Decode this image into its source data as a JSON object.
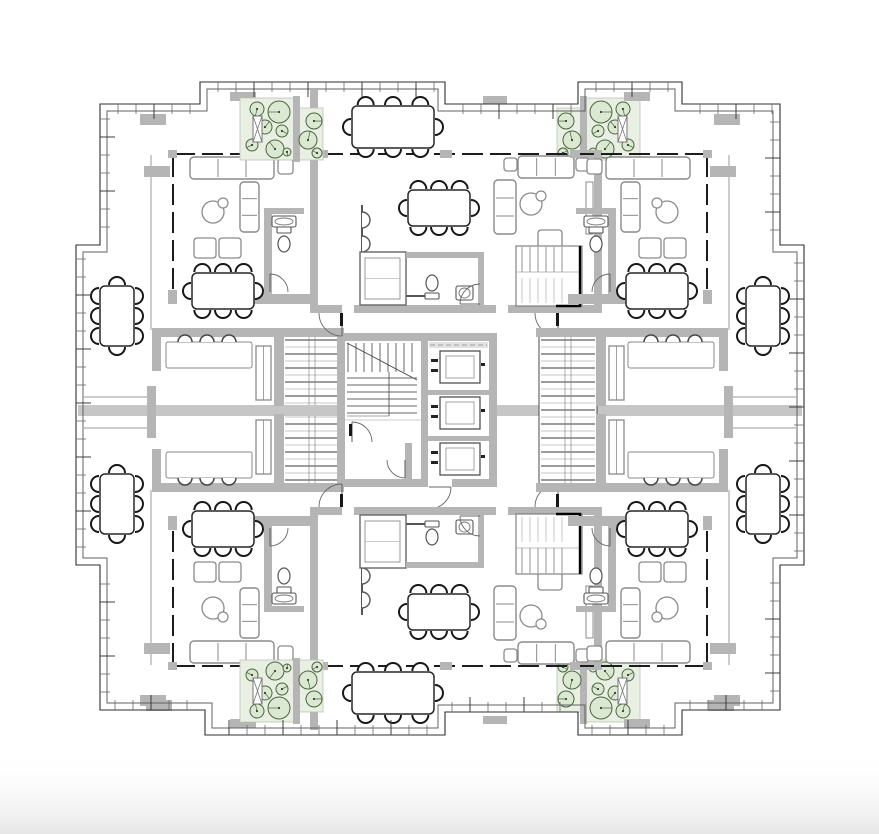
{
  "meta": {
    "title": "Residential tower typical floor plan",
    "type": "architectural-plan"
  },
  "canvas": {
    "w": 879,
    "h": 834,
    "bg": "#ffffff",
    "fade": {
      "y": 752,
      "h": 82,
      "from": "#ffffff",
      "to": "#e7e7e7"
    }
  },
  "mirror": {
    "cx": 440,
    "cy": 410
  },
  "palette": {
    "wall": "#b5b5b5",
    "band": "#c6c6c6",
    "pl": "#e9f0e3",
    "plb": "#b9c6b1",
    "treeFill": "#dce9d2",
    "treeLine": "#4a653e",
    "line": "#2f2f2f",
    "inner": "#606060",
    "furn": "#8a8a8a",
    "dark": "#171717",
    "win": "#1c1c1c"
  },
  "facade": {
    "outer": [
      [
        100,
        104
      ],
      [
        200,
        104
      ],
      [
        200,
        82
      ],
      [
        445,
        82
      ],
      [
        445,
        104
      ],
      [
        578,
        104
      ],
      [
        578,
        82
      ],
      [
        682,
        82
      ],
      [
        682,
        104
      ],
      [
        780,
        104
      ],
      [
        780,
        245
      ],
      [
        804,
        245
      ],
      [
        804,
        565
      ],
      [
        780,
        565
      ],
      [
        780,
        710
      ],
      [
        682,
        710
      ],
      [
        682,
        735
      ],
      [
        578,
        735
      ],
      [
        578,
        712
      ],
      [
        445,
        712
      ],
      [
        445,
        735
      ],
      [
        205,
        735
      ],
      [
        205,
        710
      ],
      [
        100,
        710
      ],
      [
        100,
        565
      ],
      [
        76,
        565
      ],
      [
        76,
        245
      ],
      [
        100,
        245
      ]
    ],
    "inner": [
      [
        107,
        111
      ],
      [
        207,
        111
      ],
      [
        207,
        89
      ],
      [
        438,
        89
      ],
      [
        438,
        111
      ],
      [
        585,
        111
      ],
      [
        585,
        89
      ],
      [
        675,
        89
      ],
      [
        675,
        111
      ],
      [
        773,
        111
      ],
      [
        773,
        252
      ],
      [
        797,
        252
      ],
      [
        797,
        558
      ],
      [
        773,
        558
      ],
      [
        773,
        703
      ],
      [
        675,
        703
      ],
      [
        675,
        728
      ],
      [
        585,
        728
      ],
      [
        585,
        705
      ],
      [
        438,
        705
      ],
      [
        438,
        728
      ],
      [
        212,
        728
      ],
      [
        212,
        703
      ],
      [
        107,
        703
      ],
      [
        107,
        558
      ],
      [
        83,
        558
      ],
      [
        83,
        252
      ],
      [
        107,
        252
      ]
    ],
    "tickStep": 18,
    "tickMajorEvery": 3
  },
  "items": [
    {
      "t": "rect",
      "r": [
        557,
        108,
        26,
        52
      ],
      "f": "pl",
      "s": "plb",
      "w": 0.8,
      "m": "x y xy",
      "name": "planter-small"
    },
    {
      "t": "rect",
      "r": [
        586,
        98,
        54,
        62
      ],
      "f": "pl",
      "s": "plb",
      "w": 0.8,
      "m": "x y xy",
      "name": "planter-large"
    },
    {
      "t": "rect",
      "r": [
        580,
        96,
        7,
        66
      ],
      "f": "wall",
      "m": "x y xy",
      "name": "planter-divider-wall"
    },
    {
      "t": "trees",
      "c": [
        [
          601,
          112,
          11
        ],
        [
          623,
          109,
          7
        ],
        [
          598,
          131,
          6
        ],
        [
          615,
          127,
          7
        ],
        [
          605,
          149,
          9
        ],
        [
          628,
          145,
          6
        ],
        [
          593,
          152,
          4
        ],
        [
          566,
          121,
          8
        ],
        [
          572,
          140,
          9
        ],
        [
          563,
          153,
          5
        ]
      ],
      "m": "x y xy",
      "name": "terrace-trees"
    },
    {
      "t": "bench",
      "r": [
        618,
        116,
        9,
        26
      ],
      "m": "x y xy",
      "name": "terrace-bench"
    },
    {
      "t": "shaft",
      "r": [
        283,
        333,
        58,
        154
      ],
      "m": "x",
      "name": "scissor-stair-shaft"
    },
    {
      "t": "rect",
      "r": [
        78,
        405,
        263,
        11
      ],
      "f": "band",
      "name": "expansion-band"
    },
    {
      "t": "rect",
      "r": [
        497,
        405,
        305,
        11
      ],
      "f": "band",
      "name": "expansion-band"
    },
    {
      "t": "line",
      "p": [
        84,
        397,
        151,
        397
      ],
      "s": "#9a9a9a",
      "w": 1,
      "m": "x",
      "name": "terrace-edge-line"
    },
    {
      "t": "line",
      "p": [
        84,
        428,
        151,
        428
      ],
      "s": "#9a9a9a",
      "w": 1,
      "m": "x",
      "name": "terrace-edge-line"
    },
    {
      "t": "rect",
      "r": [
        147,
        386,
        9,
        52
      ],
      "f": "wall",
      "m": "x",
      "name": "terrace-pier"
    },
    {
      "t": "rect",
      "r": [
        152,
        328,
        192,
        9
      ],
      "f": "wall",
      "m": "x y xy",
      "name": "midroom-wall"
    },
    {
      "t": "rect",
      "r": [
        152,
        337,
        9,
        34
      ],
      "f": "wall",
      "m": "x y xy",
      "name": "midroom-wall"
    },
    {
      "t": "rect",
      "r": [
        274,
        330,
        10,
        76
      ],
      "f": "wall",
      "m": "x y xy",
      "name": "midroom-wall"
    },
    {
      "t": "rect",
      "r": [
        166,
        342,
        86,
        26
      ],
      "s": "furn",
      "f": "#fff",
      "rx": 2,
      "m": "x y xy",
      "name": "daybed"
    },
    {
      "t": "chairs",
      "c": [
        [
          185,
          342
        ],
        [
          207,
          342
        ],
        [
          229,
          342
        ]
      ],
      "d": "up",
      "cr": 7,
      "m": "x y xy",
      "name": "seat-scallops"
    },
    {
      "t": "cab",
      "r": [
        256,
        346,
        15,
        54
      ],
      "m": "x y xy",
      "name": "cabinet"
    },
    {
      "t": "rect",
      "r": [
        337,
        333,
        8,
        154
      ],
      "f": "wall",
      "name": "core-wall"
    },
    {
      "t": "rect",
      "r": [
        337,
        333,
        160,
        8
      ],
      "f": "wall",
      "name": "core-wall"
    },
    {
      "t": "rect",
      "r": [
        489,
        333,
        8,
        154
      ],
      "f": "wall",
      "name": "core-wall"
    },
    {
      "t": "rect",
      "r": [
        337,
        479,
        90,
        8
      ],
      "f": "wall",
      "name": "core-wall"
    },
    {
      "t": "rect",
      "r": [
        452,
        479,
        45,
        8
      ],
      "f": "wall",
      "name": "core-wall"
    },
    {
      "t": "rect",
      "r": [
        421,
        341,
        7,
        146
      ],
      "f": "wall",
      "name": "core-wall"
    },
    {
      "t": "corestair",
      "r": [
        345,
        341,
        76,
        146
      ],
      "name": "core-stairs"
    },
    {
      "t": "elev",
      "r": [
        428,
        341,
        61,
        146
      ],
      "name": "elevator-bank"
    },
    {
      "t": "arc",
      "a": [
        352,
        442,
        20,
        270,
        360
      ],
      "name": "door-swing"
    },
    {
      "t": "arc",
      "a": [
        429,
        487,
        22,
        0,
        90
      ],
      "name": "door-swing"
    },
    {
      "t": "rect",
      "r": [
        349,
        424,
        3,
        12
      ],
      "f": "dark",
      "name": "door-leaf"
    },
    {
      "t": "rect",
      "r": [
        405,
        443,
        7,
        44
      ],
      "f": "wall",
      "name": "core-wall"
    },
    {
      "t": "arc",
      "a": [
        405,
        460,
        18,
        90,
        180
      ],
      "name": "door-swing"
    },
    {
      "t": "rect",
      "r": [
        310,
        90,
        8,
        223
      ],
      "f": "wall",
      "m": "y",
      "name": "unit-wall"
    },
    {
      "t": "rect",
      "r": [
        594,
        150,
        8,
        163
      ],
      "f": "wall",
      "m": "y",
      "name": "unit-wall"
    },
    {
      "t": "rect",
      "r": [
        310,
        305,
        32,
        8
      ],
      "f": "wall",
      "m": "y",
      "name": "unit-wall"
    },
    {
      "t": "rect",
      "r": [
        354,
        305,
        142,
        8
      ],
      "f": "wall",
      "m": "y",
      "name": "unit-wall"
    },
    {
      "t": "rect",
      "r": [
        508,
        305,
        94,
        8
      ],
      "f": "wall",
      "m": "y",
      "name": "unit-wall"
    },
    {
      "t": "dash",
      "p": [
        322,
        154,
        592,
        154
      ],
      "m": "y",
      "name": "window-wall"
    },
    {
      "t": "rect",
      "r": [
        318,
        150,
        10,
        8
      ],
      "f": "wall",
      "m": "y",
      "name": "mullion-pier"
    },
    {
      "t": "rect",
      "r": [
        440,
        150,
        12,
        8
      ],
      "f": "wall",
      "m": "y",
      "name": "mullion-pier"
    },
    {
      "t": "rect",
      "r": [
        584,
        150,
        10,
        8
      ],
      "f": "wall",
      "m": "y",
      "name": "mullion-pier"
    },
    {
      "t": "kitchen",
      "p": [
        362,
        205,
        362,
        296,
        432,
        296
      ],
      "ar": [
        [
          362,
          220
        ],
        [
          362,
          244
        ],
        [
          362,
          268
        ]
      ],
      "m": "y",
      "name": "kitchen-counter"
    },
    {
      "t": "tableH",
      "r": [
        408,
        190,
        62,
        36
      ],
      "m": "y",
      "name": "dining-table"
    },
    {
      "t": "sofa",
      "r": [
        518,
        156,
        56,
        22
      ],
      "m": "y",
      "name": "sofa"
    },
    {
      "t": "sq",
      "r": [
        504,
        158,
        13,
        13
      ],
      "m": "y",
      "name": "side-table"
    },
    {
      "t": "sq",
      "r": [
        576,
        158,
        13,
        13
      ],
      "m": "y",
      "name": "side-table"
    },
    {
      "t": "chaise",
      "r": [
        494,
        180,
        22,
        54
      ],
      "m": "y",
      "name": "chaise"
    },
    {
      "t": "rtable",
      "c": [
        531,
        204,
        11,
        541,
        196,
        5
      ],
      "m": "y",
      "name": "coffee-table"
    },
    {
      "t": "sq",
      "r": [
        538,
        230,
        24,
        22
      ],
      "m": "y",
      "name": "armchair"
    },
    {
      "t": "rect",
      "r": [
        586,
        182,
        7,
        52
      ],
      "s": "furn",
      "f": "#fff",
      "m": "y",
      "name": "console"
    },
    {
      "t": "closet",
      "r": [
        360,
        252,
        46,
        53
      ],
      "m": "y",
      "name": "wardrobe"
    },
    {
      "t": "rect",
      "r": [
        406,
        252,
        78,
        6
      ],
      "f": "wall",
      "m": "y",
      "name": "bath-wall"
    },
    {
      "t": "rect",
      "r": [
        478,
        252,
        6,
        56
      ],
      "f": "wall",
      "m": "y",
      "name": "bath-wall"
    },
    {
      "t": "toilet",
      "c": [
        432,
        283
      ],
      "tk": "s",
      "m": "y",
      "name": "toilet"
    },
    {
      "t": "sink",
      "r": [
        456,
        286,
        17,
        14
      ],
      "m": "y",
      "name": "sink"
    },
    {
      "t": "arc",
      "a": [
        480,
        304,
        20,
        180,
        270
      ],
      "m": "y",
      "name": "door-swing"
    },
    {
      "t": "stairs",
      "r": [
        516,
        246,
        66,
        60
      ],
      "m": "y",
      "name": "duplex-stair"
    },
    {
      "t": "arc",
      "a": [
        342,
        313,
        23,
        90,
        180
      ],
      "m": "y",
      "name": "door-swing"
    },
    {
      "t": "rect",
      "r": [
        340,
        313,
        3,
        13
      ],
      "f": "dark",
      "m": "y",
      "name": "door-leaf"
    },
    {
      "t": "arc",
      "a": [
        558,
        313,
        23,
        90,
        180
      ],
      "m": "y",
      "name": "door-swing"
    },
    {
      "t": "rect",
      "r": [
        556,
        313,
        3,
        13
      ],
      "f": "dark",
      "m": "y",
      "name": "door-leaf"
    },
    {
      "t": "dash",
      "p": [
        174,
        154,
        306,
        154
      ],
      "m": "x y xy",
      "name": "window-wall"
    },
    {
      "t": "dashv",
      "p": [
        173,
        156,
        173,
        298
      ],
      "m": "x y xy",
      "name": "window-wall"
    },
    {
      "t": "rect",
      "r": [
        168,
        150,
        9,
        8
      ],
      "f": "wall",
      "m": "x y xy",
      "name": "mullion-pier"
    },
    {
      "t": "rect",
      "r": [
        300,
        150,
        10,
        8
      ],
      "f": "wall",
      "m": "x y xy",
      "name": "mullion-pier"
    },
    {
      "t": "rect",
      "r": [
        230,
        294,
        82,
        10
      ],
      "f": "wall",
      "m": "x y xy",
      "name": "unit-wall"
    },
    {
      "t": "rect",
      "r": [
        168,
        290,
        9,
        14
      ],
      "f": "wall",
      "m": "x y xy",
      "name": "unit-wall"
    },
    {
      "t": "sofa",
      "r": [
        190,
        157,
        84,
        22
      ],
      "m": "x y xy",
      "name": "sofa"
    },
    {
      "t": "sq",
      "r": [
        278,
        159,
        15,
        15
      ],
      "m": "x y xy",
      "name": "side-table"
    },
    {
      "t": "chaise",
      "r": [
        240,
        182,
        19,
        50
      ],
      "m": "x y xy",
      "name": "chaise"
    },
    {
      "t": "rtable",
      "c": [
        213,
        212,
        11,
        223,
        203,
        5
      ],
      "m": "x y xy",
      "name": "coffee-table"
    },
    {
      "t": "sq",
      "r": [
        194,
        238,
        22,
        20
      ],
      "m": "x y xy",
      "name": "armchair"
    },
    {
      "t": "sq",
      "r": [
        219,
        238,
        22,
        20
      ],
      "m": "x y xy",
      "name": "armchair"
    },
    {
      "t": "tableH",
      "r": [
        192,
        273,
        62,
        36
      ],
      "m": "x y xy",
      "name": "dining-table"
    },
    {
      "t": "rect",
      "r": [
        264,
        208,
        8,
        88
      ],
      "f": "wall",
      "m": "x y xy",
      "name": "bath-wall"
    },
    {
      "t": "rect",
      "r": [
        264,
        208,
        40,
        6
      ],
      "f": "wall",
      "m": "x y xy",
      "name": "bath-wall"
    },
    {
      "t": "sink",
      "r": [
        272,
        216,
        24,
        11
      ],
      "m": "x y xy",
      "name": "sink"
    },
    {
      "t": "toilet",
      "c": [
        284,
        244
      ],
      "tk": "n",
      "m": "x y xy",
      "name": "toilet"
    },
    {
      "t": "arc",
      "a": [
        270,
        292,
        18,
        270,
        360
      ],
      "m": "x y xy",
      "name": "door-swing"
    },
    {
      "t": "line",
      "p": [
        151,
        155,
        151,
        330
      ],
      "s": "#999999",
      "w": 1,
      "m": "x y xy",
      "name": "terrace-edge-line"
    },
    {
      "t": "rect",
      "r": [
        230,
        92,
        26,
        9
      ],
      "f": "wall",
      "m": "x y xy",
      "name": "facade-pier"
    },
    {
      "t": "rect",
      "r": [
        144,
        166,
        26,
        11
      ],
      "f": "wall",
      "m": "x y xy",
      "name": "facade-pier"
    },
    {
      "t": "rect",
      "r": [
        483,
        96,
        24,
        8
      ],
      "f": "wall",
      "m": "y",
      "name": "facade-pier"
    },
    {
      "t": "rect",
      "r": [
        714,
        114,
        26,
        11
      ],
      "f": "wall",
      "m": "x y xy",
      "name": "facade-pier"
    },
    {
      "t": "rect",
      "r": [
        146,
        700,
        26,
        11
      ],
      "f": "wall",
      "m": "x",
      "name": "facade-pier"
    },
    {
      "t": "tableV",
      "r": [
        100,
        286,
        34,
        60
      ],
      "m": "x y xy",
      "name": "terrace-dining-table"
    },
    {
      "t": "tableH",
      "r": [
        352,
        106,
        82,
        42
      ],
      "m": "y",
      "name": "terrace-dining-table"
    }
  ]
}
